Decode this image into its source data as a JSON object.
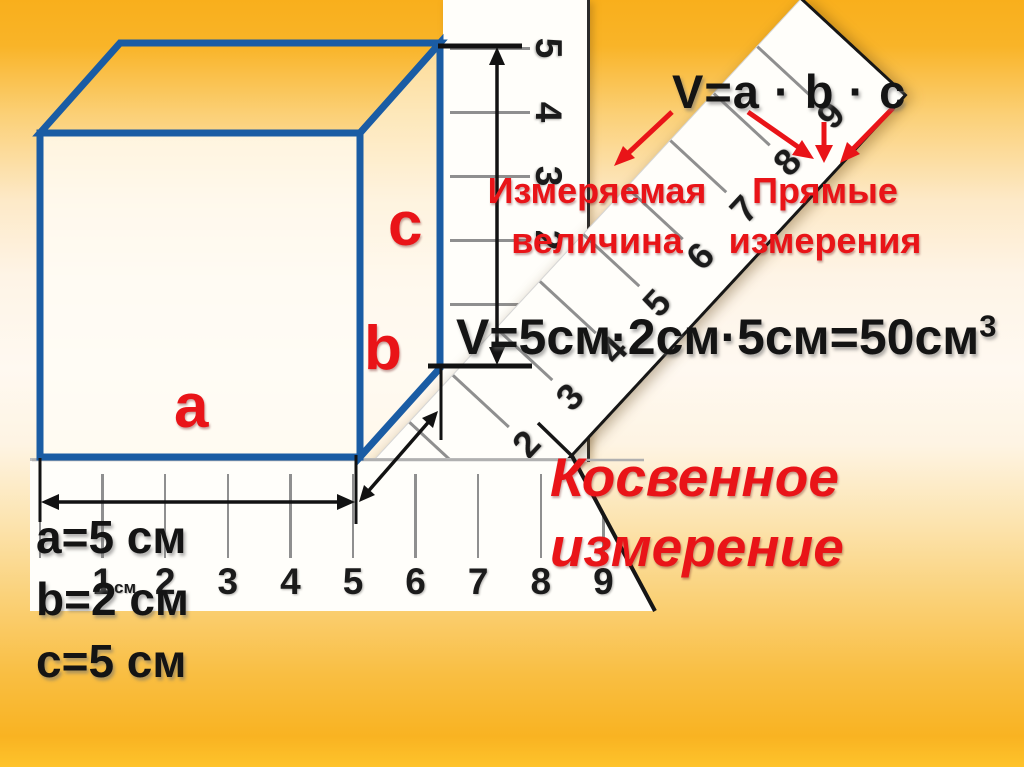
{
  "slide": {
    "formula_top": "V=a · b · c",
    "measured_label": {
      "line1": "Измеряемая",
      "line2": "величина"
    },
    "direct_label": {
      "line1": "Прямые",
      "line2": "измерения"
    },
    "calc_formula": {
      "base": "V=5см·2см·5см=50см",
      "sup": "3"
    },
    "indirect_label": {
      "line1": "Косвенное",
      "line2": "измерение"
    },
    "dims": {
      "a": "a=5 см",
      "b": "b=2 см",
      "c": "c=5 см"
    },
    "cube_labels": {
      "a": "a",
      "b": "b",
      "c": "c"
    }
  },
  "rulers": {
    "horizontal": {
      "numbers": [
        "1",
        "2",
        "3",
        "4",
        "5",
        "6",
        "7",
        "8",
        "9"
      ],
      "unit": "см"
    },
    "vertical": {
      "numbers": [
        "5",
        "4",
        "3",
        "2",
        "1"
      ]
    },
    "diagonal": {
      "numbers": [
        "2",
        "3",
        "4",
        "5",
        "6",
        "7",
        "8",
        "9"
      ]
    }
  },
  "colors": {
    "cube_blue": "#1A5CA4",
    "accent_red": "#E91418",
    "ruler_white": "#FFFEFA",
    "background_orange": "#F9B322"
  }
}
